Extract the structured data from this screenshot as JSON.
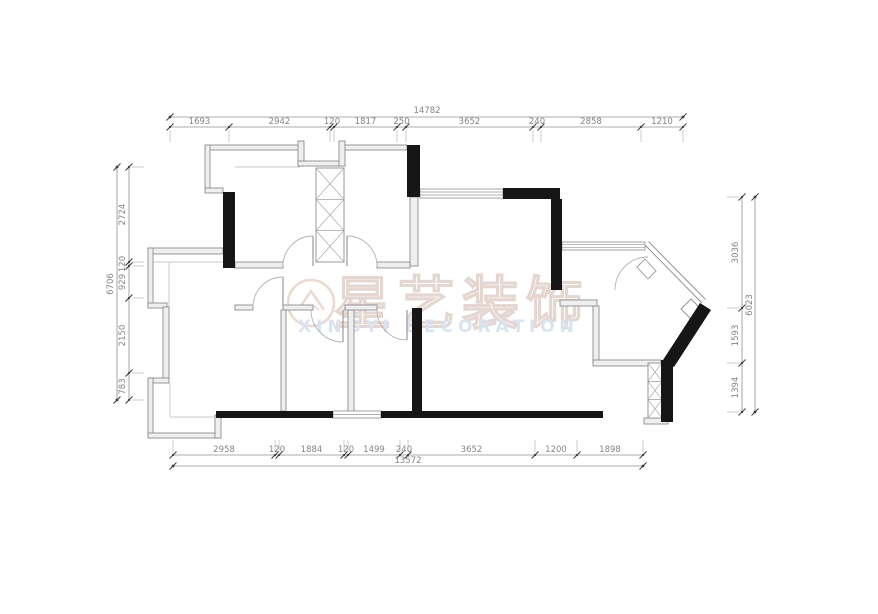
{
  "watermark": {
    "company_cn": "星艺装饰",
    "company_en": "XINGYI DECORATION",
    "logo_icon": "house-in-circle",
    "cn_color": "#e4d6d1",
    "en_color": "#d9e4f0"
  },
  "colors": {
    "wall_black": "#161616",
    "wall_thin_stroke": "#8d8d8d",
    "wall_thin_fill": "#efefef",
    "window_stroke": "#999999",
    "shaft_stroke": "#909090",
    "shaft_hatch": "#aaaaaa",
    "door_arc": "#b3b3b3",
    "door_leaf": "#9a9a9a",
    "light_line": "#c9c9c9",
    "dim_line": "#909090",
    "dim_tick": "#3c3c3c",
    "dim_text": "#858585",
    "dim_stub": "#c0c0c0"
  },
  "dims": {
    "top": {
      "overall": {
        "label": "14782",
        "y": 117,
        "x1": 170,
        "x2": 683,
        "label_x": 427,
        "label_y": 113
      },
      "segments": {
        "y": 127,
        "ticks": [
          170,
          229,
          330,
          334,
          397,
          406,
          533,
          541,
          641,
          683
        ],
        "labels": [
          "1693",
          "2942",
          "120",
          "1817",
          "250",
          "3652",
          "240",
          "2858",
          "1210"
        ]
      }
    },
    "bottom": {
      "overall": {
        "label": "13572",
        "y": 466,
        "x1": 173,
        "x2": 643,
        "label_x": 408,
        "label_y": 463
      },
      "segments": {
        "y": 455,
        "ticks": [
          173,
          275,
          279,
          344,
          348,
          400,
          408,
          535,
          577,
          643
        ],
        "labels": [
          "2958",
          "120",
          "1884",
          "120",
          "1499",
          "240",
          "3652",
          "1200",
          "1898"
        ]
      }
    },
    "left": {
      "overall": {
        "label": "6706",
        "x": 117,
        "y1": 167,
        "y2": 400,
        "label_x": 113,
        "label_y": 284
      },
      "segments": {
        "x": 129,
        "ticks": [
          167,
          262,
          266,
          298,
          373,
          400
        ],
        "labels": [
          "2724",
          "120",
          "929",
          "2150",
          "783"
        ]
      }
    },
    "right": {
      "overall": {
        "label": "6023",
        "x": 755,
        "y1": 197,
        "y2": 412,
        "label_x": 752,
        "label_y": 305
      },
      "segments": {
        "x": 742,
        "ticks": [
          197,
          308,
          363,
          412
        ],
        "labels": [
          "3036",
          "1593",
          "1394"
        ]
      }
    }
  },
  "geometry": {
    "black_walls": [
      {
        "x": 223,
        "y": 192,
        "w": 12,
        "h": 76
      },
      {
        "x": 407,
        "y": 145,
        "w": 13,
        "h": 52
      },
      {
        "x": 503,
        "y": 188,
        "w": 57,
        "h": 11
      },
      {
        "x": 551,
        "y": 199,
        "w": 11,
        "h": 91
      },
      {
        "x": 661,
        "y": 360,
        "w": 12,
        "h": 62
      },
      {
        "x": 216,
        "y": 411,
        "w": 117,
        "h": 7
      },
      {
        "x": 381,
        "y": 411,
        "w": 222,
        "h": 7
      },
      {
        "x": 412,
        "y": 308,
        "w": 10,
        "h": 103
      }
    ],
    "black_polys": [
      "700,303 711,310 674,367 663,360"
    ],
    "thin_walls": [
      {
        "x": 205,
        "y": 145,
        "w": 95,
        "h": 5
      },
      {
        "x": 205,
        "y": 145,
        "w": 5,
        "h": 47
      },
      {
        "x": 205,
        "y": 188,
        "w": 18,
        "h": 5
      },
      {
        "x": 298,
        "y": 141,
        "w": 6,
        "h": 25
      },
      {
        "x": 298,
        "y": 161,
        "w": 47,
        "h": 5
      },
      {
        "x": 339,
        "y": 141,
        "w": 6,
        "h": 25
      },
      {
        "x": 345,
        "y": 145,
        "w": 62,
        "h": 5
      },
      {
        "x": 148,
        "y": 248,
        "w": 75,
        "h": 6
      },
      {
        "x": 148,
        "y": 248,
        "w": 5,
        "h": 59
      },
      {
        "x": 148,
        "y": 303,
        "w": 19,
        "h": 5
      },
      {
        "x": 163,
        "y": 307,
        "w": 6,
        "h": 73
      },
      {
        "x": 148,
        "y": 378,
        "w": 21,
        "h": 5
      },
      {
        "x": 148,
        "y": 378,
        "w": 5,
        "h": 60
      },
      {
        "x": 148,
        "y": 433,
        "w": 72,
        "h": 5
      },
      {
        "x": 215,
        "y": 415,
        "w": 6,
        "h": 23
      },
      {
        "x": 235,
        "y": 262,
        "w": 48,
        "h": 6
      },
      {
        "x": 377,
        "y": 262,
        "w": 33,
        "h": 6
      },
      {
        "x": 410,
        "y": 197,
        "w": 8,
        "h": 69
      },
      {
        "x": 235,
        "y": 305,
        "w": 18,
        "h": 5
      },
      {
        "x": 283,
        "y": 305,
        "w": 30,
        "h": 5
      },
      {
        "x": 345,
        "y": 305,
        "w": 32,
        "h": 5
      },
      {
        "x": 281,
        "y": 310,
        "w": 5,
        "h": 101
      },
      {
        "x": 348,
        "y": 310,
        "w": 6,
        "h": 101
      },
      {
        "x": 560,
        "y": 300,
        "w": 37,
        "h": 6
      },
      {
        "x": 593,
        "y": 306,
        "w": 6,
        "h": 57
      },
      {
        "x": 593,
        "y": 360,
        "w": 68,
        "h": 6
      },
      {
        "x": 644,
        "y": 418,
        "w": 24,
        "h": 6
      }
    ],
    "windows": [
      {
        "x": 420,
        "y": 189,
        "w": 83,
        "h": 9,
        "lines": 4
      },
      {
        "x": 562,
        "y": 242,
        "w": 83,
        "h": 8,
        "lines": 4
      },
      {
        "x": 333,
        "y": 411,
        "w": 48,
        "h": 7,
        "lines": 3
      }
    ],
    "shafts": [
      {
        "x": 316,
        "y": 168,
        "w": 28,
        "h": 94,
        "cells": 3
      },
      {
        "x": 648,
        "y": 363,
        "w": 14,
        "h": 55,
        "cells": 3
      }
    ],
    "diagonals": [
      {
        "x1": 645,
        "y1": 245,
        "x2": 702,
        "y2": 303,
        "ox": 3.5,
        "oy": -3.5
      }
    ],
    "diag_window_poly": "681,309 691,299 703,311 693,321",
    "door_arcs": [
      "M 283 266 A 30 30 0 0 1 313 236",
      "M 347 236 A 30 30 0 0 1 377 266",
      "M 343 342 A 32 32 0 0 1 311 310",
      "M 407 340 A 30 30 0 0 1 377 310",
      "M 253 307 A 30 30 0 0 1 283 277",
      "M 615 290 A 33 33 0 0 1 648 257"
    ],
    "door_leaves": [
      [
        313,
        266,
        313,
        236
      ],
      [
        347,
        266,
        347,
        236
      ],
      [
        343,
        310,
        343,
        342
      ],
      [
        407,
        310,
        407,
        340
      ],
      [
        283,
        307,
        283,
        277
      ]
    ],
    "door_leaf_polys": [
      "637,267 645,259 656,271 648,279"
    ],
    "light_lines": [
      [
        235,
        167,
        300,
        167
      ],
      [
        153,
        262,
        223,
        262
      ],
      [
        169,
        262,
        169,
        307
      ],
      [
        170,
        383,
        170,
        417
      ],
      [
        170,
        417,
        216,
        417
      ]
    ]
  }
}
